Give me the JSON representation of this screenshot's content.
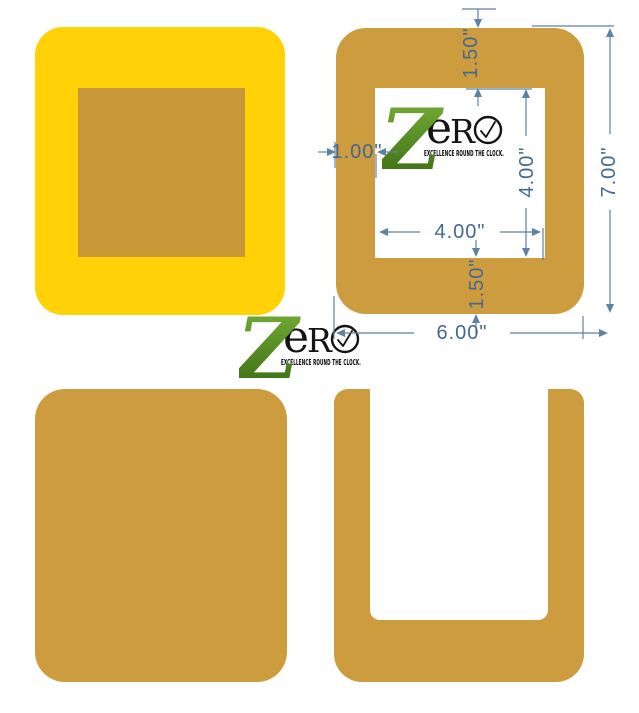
{
  "image": {
    "description": "Product dimension diagram of square paper frames",
    "background": "#ffffff"
  },
  "colors": {
    "yellow_frame": "#FFD106",
    "tan_panel": "#CC9C3E",
    "tan_inset": "#C89838",
    "dimension_lines": "#5E81A4",
    "dimension_text": "#44688F",
    "logo_green_light": "#7BB43A",
    "logo_green_dark": "#35660F",
    "logo_black": "#141414"
  },
  "logo": {
    "z": "Z",
    "e": "e",
    "r": "R",
    "o_icon": "clock-in-letter-o",
    "tagline": "EXCELLENCE ROUND THE CLOCK."
  },
  "dimensions": {
    "top_border": "1.50\"",
    "left_border": "1.00\"",
    "opening_height": "4.00\"",
    "opening_width": "4.00\"",
    "bottom_border": "1.50\"",
    "overall_width": "6.00\"",
    "overall_height": "7.00\""
  }
}
